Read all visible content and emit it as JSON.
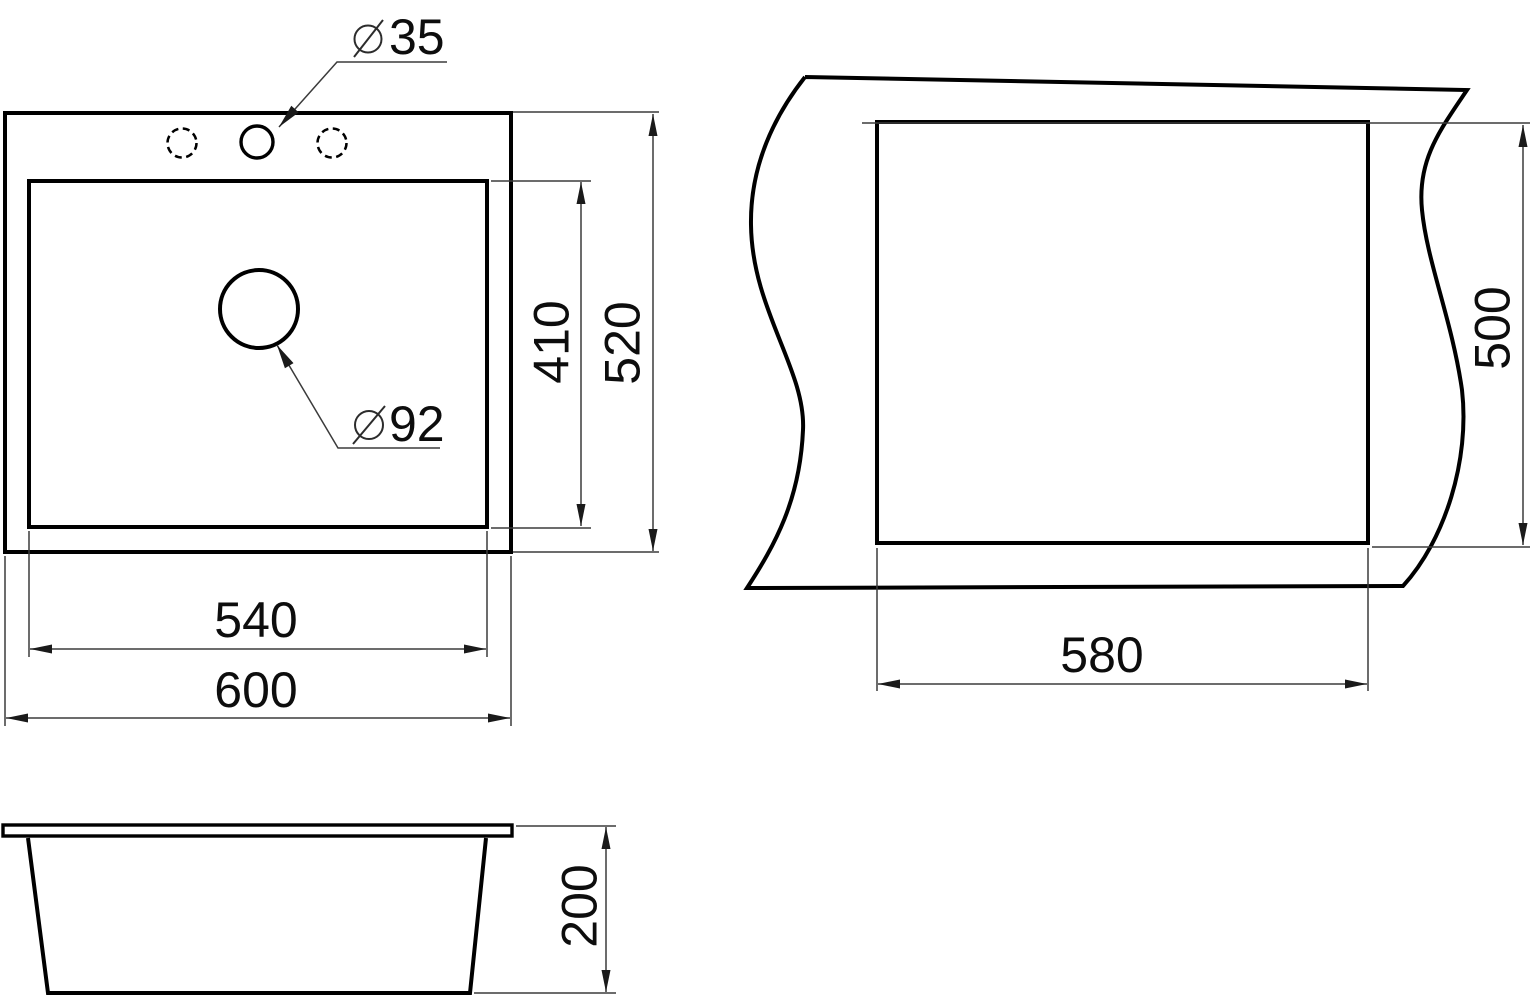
{
  "drawing_title": "sink-dimension-drawing",
  "symbols": {
    "diameter": "⌀"
  },
  "top_view": {
    "overall_width": "600",
    "overall_depth": "520",
    "bowl_width": "540",
    "bowl_depth": "410",
    "faucet_hole_diameter": "35",
    "drain_hole_diameter": "92"
  },
  "cutout_view": {
    "width": "580",
    "height": "500"
  },
  "side_view": {
    "height": "200"
  },
  "colors": {
    "object_line": "#000000",
    "dimension_line": "#3b3b3b",
    "text": "#0d0d0d",
    "background": "#ffffff"
  }
}
